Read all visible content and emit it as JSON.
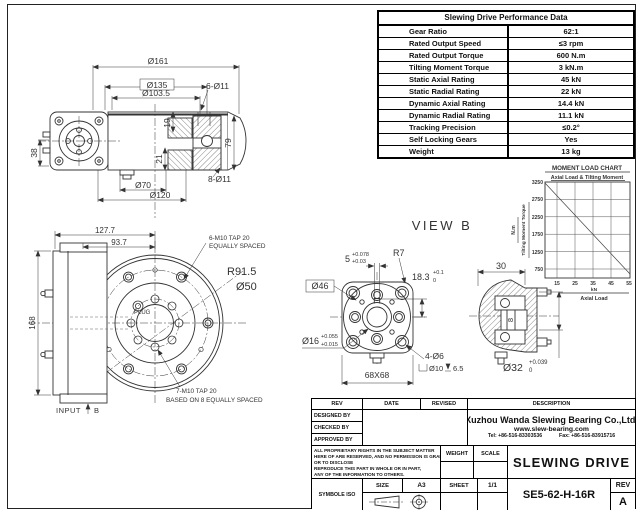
{
  "perf_table": {
    "title": "Slewing Drive Performance Data",
    "rows": [
      {
        "label": "Gear Ratio",
        "value": "62:1"
      },
      {
        "label": "Rated Output Speed",
        "value": "≤3 rpm"
      },
      {
        "label": "Rated Output Torque",
        "value": "600 N.m"
      },
      {
        "label": "Tilting Moment Torque",
        "value": "3 kN.m"
      },
      {
        "label": "Static Axial Rating",
        "value": "45 kN"
      },
      {
        "label": "Static Radial Rating",
        "value": "22 kN"
      },
      {
        "label": "Dynamic Axial Rating",
        "value": "14.4 kN"
      },
      {
        "label": "Dynamic Radial Rating",
        "value": "11.1 kN"
      },
      {
        "label": "Tracking  Precision",
        "value": "≤0.2°"
      },
      {
        "label": "Self Locking Gears",
        "value": "Yes"
      },
      {
        "label": "Weight",
        "value": "13 kg"
      }
    ]
  },
  "chart_data": {
    "type": "line",
    "title": "MOMENT LOAD CHART",
    "subtitle": "Axial Load & Tilting Moment",
    "ylabel": "Tilting Moment Torque",
    "y_unit": "N.m",
    "xlabel": "Axial Load",
    "x_unit": "kN",
    "xticks": [
      15,
      25,
      35,
      45,
      55
    ],
    "yticks": [
      3250,
      2750,
      2250,
      1750,
      1250,
      750
    ],
    "xlim": [
      10,
      55
    ],
    "ylim": [
      600,
      3250
    ],
    "grid": true,
    "legend": "none",
    "series": [
      {
        "name": "permissible load limit",
        "x": [
          10,
          55
        ],
        "y": [
          3250,
          700
        ]
      }
    ]
  },
  "views": {
    "side": {
      "dims": {
        "d161": "Ø161",
        "d135": "Ø135",
        "d103_5": "Ø103.5",
        "n6_d11": "6-Ø11",
        "h19": "19",
        "h21": "21",
        "h38": "38",
        "d70": "Ø70",
        "d120": "Ø120",
        "n8_d11": "8-Ø11",
        "h79": "79"
      }
    },
    "front": {
      "dims": {
        "w127_7": "127.7",
        "w93_7": "93.7",
        "h168": "168",
        "r91_5": "R91.5",
        "d50": "Ø50"
      },
      "notes": {
        "tap6_line1": "6-M10 TAP 20",
        "tap6_line2": "EQUALLY SPACED",
        "tap7_line1": "7-M10 TAP 20",
        "tap7_line2": "BASED ON 8 EQUALLY SPACED",
        "plug": "PLUG",
        "input": "INPUT",
        "input_b": "B"
      }
    },
    "view_b": {
      "title": "VIEW B",
      "dims": {
        "key_w": "5",
        "key_w_tol_hi": "+0.078",
        "key_w_tol_lo": "+0.03",
        "r7": "R7",
        "key_h": "18.3",
        "key_h_tol_hi": "+0.1",
        "key_h_tol_lo": "0",
        "d46": "Ø46",
        "d16": "Ø16",
        "d16_tol_hi": "+0.055",
        "d16_tol_lo": "+0.015",
        "sq": "68X68",
        "n4_d6": "4-Ø6",
        "cbore_d": "Ø10",
        "cbore_depth": "6.5"
      }
    },
    "section": {
      "dims": {
        "w30": "30",
        "h8": "8",
        "d32": "Ø32",
        "d32_tol_hi": "+0.039",
        "d32_tol_lo": "0"
      }
    }
  },
  "title_block": {
    "rev_header": "REV",
    "date_header": "DATE",
    "revised_header": "REVISED",
    "description_header": "DESCRIPTION",
    "designed_by": "DESIGNED BY",
    "checked_by": "CHECKED BY",
    "approved_by": "APPROVED BY",
    "legal_lines": [
      "ALL PROPRIETARY RIGHTS IN THE SUBJECT MATTER",
      "HERE OF ARE RESERVED, AND NO PERMISSION IS GRANTED",
      "OR TO DISCLOSE",
      "REPRODUCE THIS PART IN WHOLE OR IN PART,",
      "ANY OF THE INFORMATION TO OTHERS."
    ],
    "company_name": "Xuzhou Wanda Slewing Bearing Co.,Ltd.",
    "website": "www.slew-bearing.com",
    "tel": "Tel: +86-516-83303536",
    "fax": "Fax: +86-516-83915716",
    "weight_label": "WEIGHT",
    "scale_label": "SCALE",
    "drawing_title": "SLEWING DRIVE",
    "size_label": "SIZE",
    "size_value": "A3",
    "sheet_label": "SHEET",
    "sheet_value": "1/1",
    "part_number": "SE5-62-H-16R",
    "rev_label": "REV",
    "rev_value": "A",
    "symbole_iso": "SYMBOLE ISO"
  }
}
